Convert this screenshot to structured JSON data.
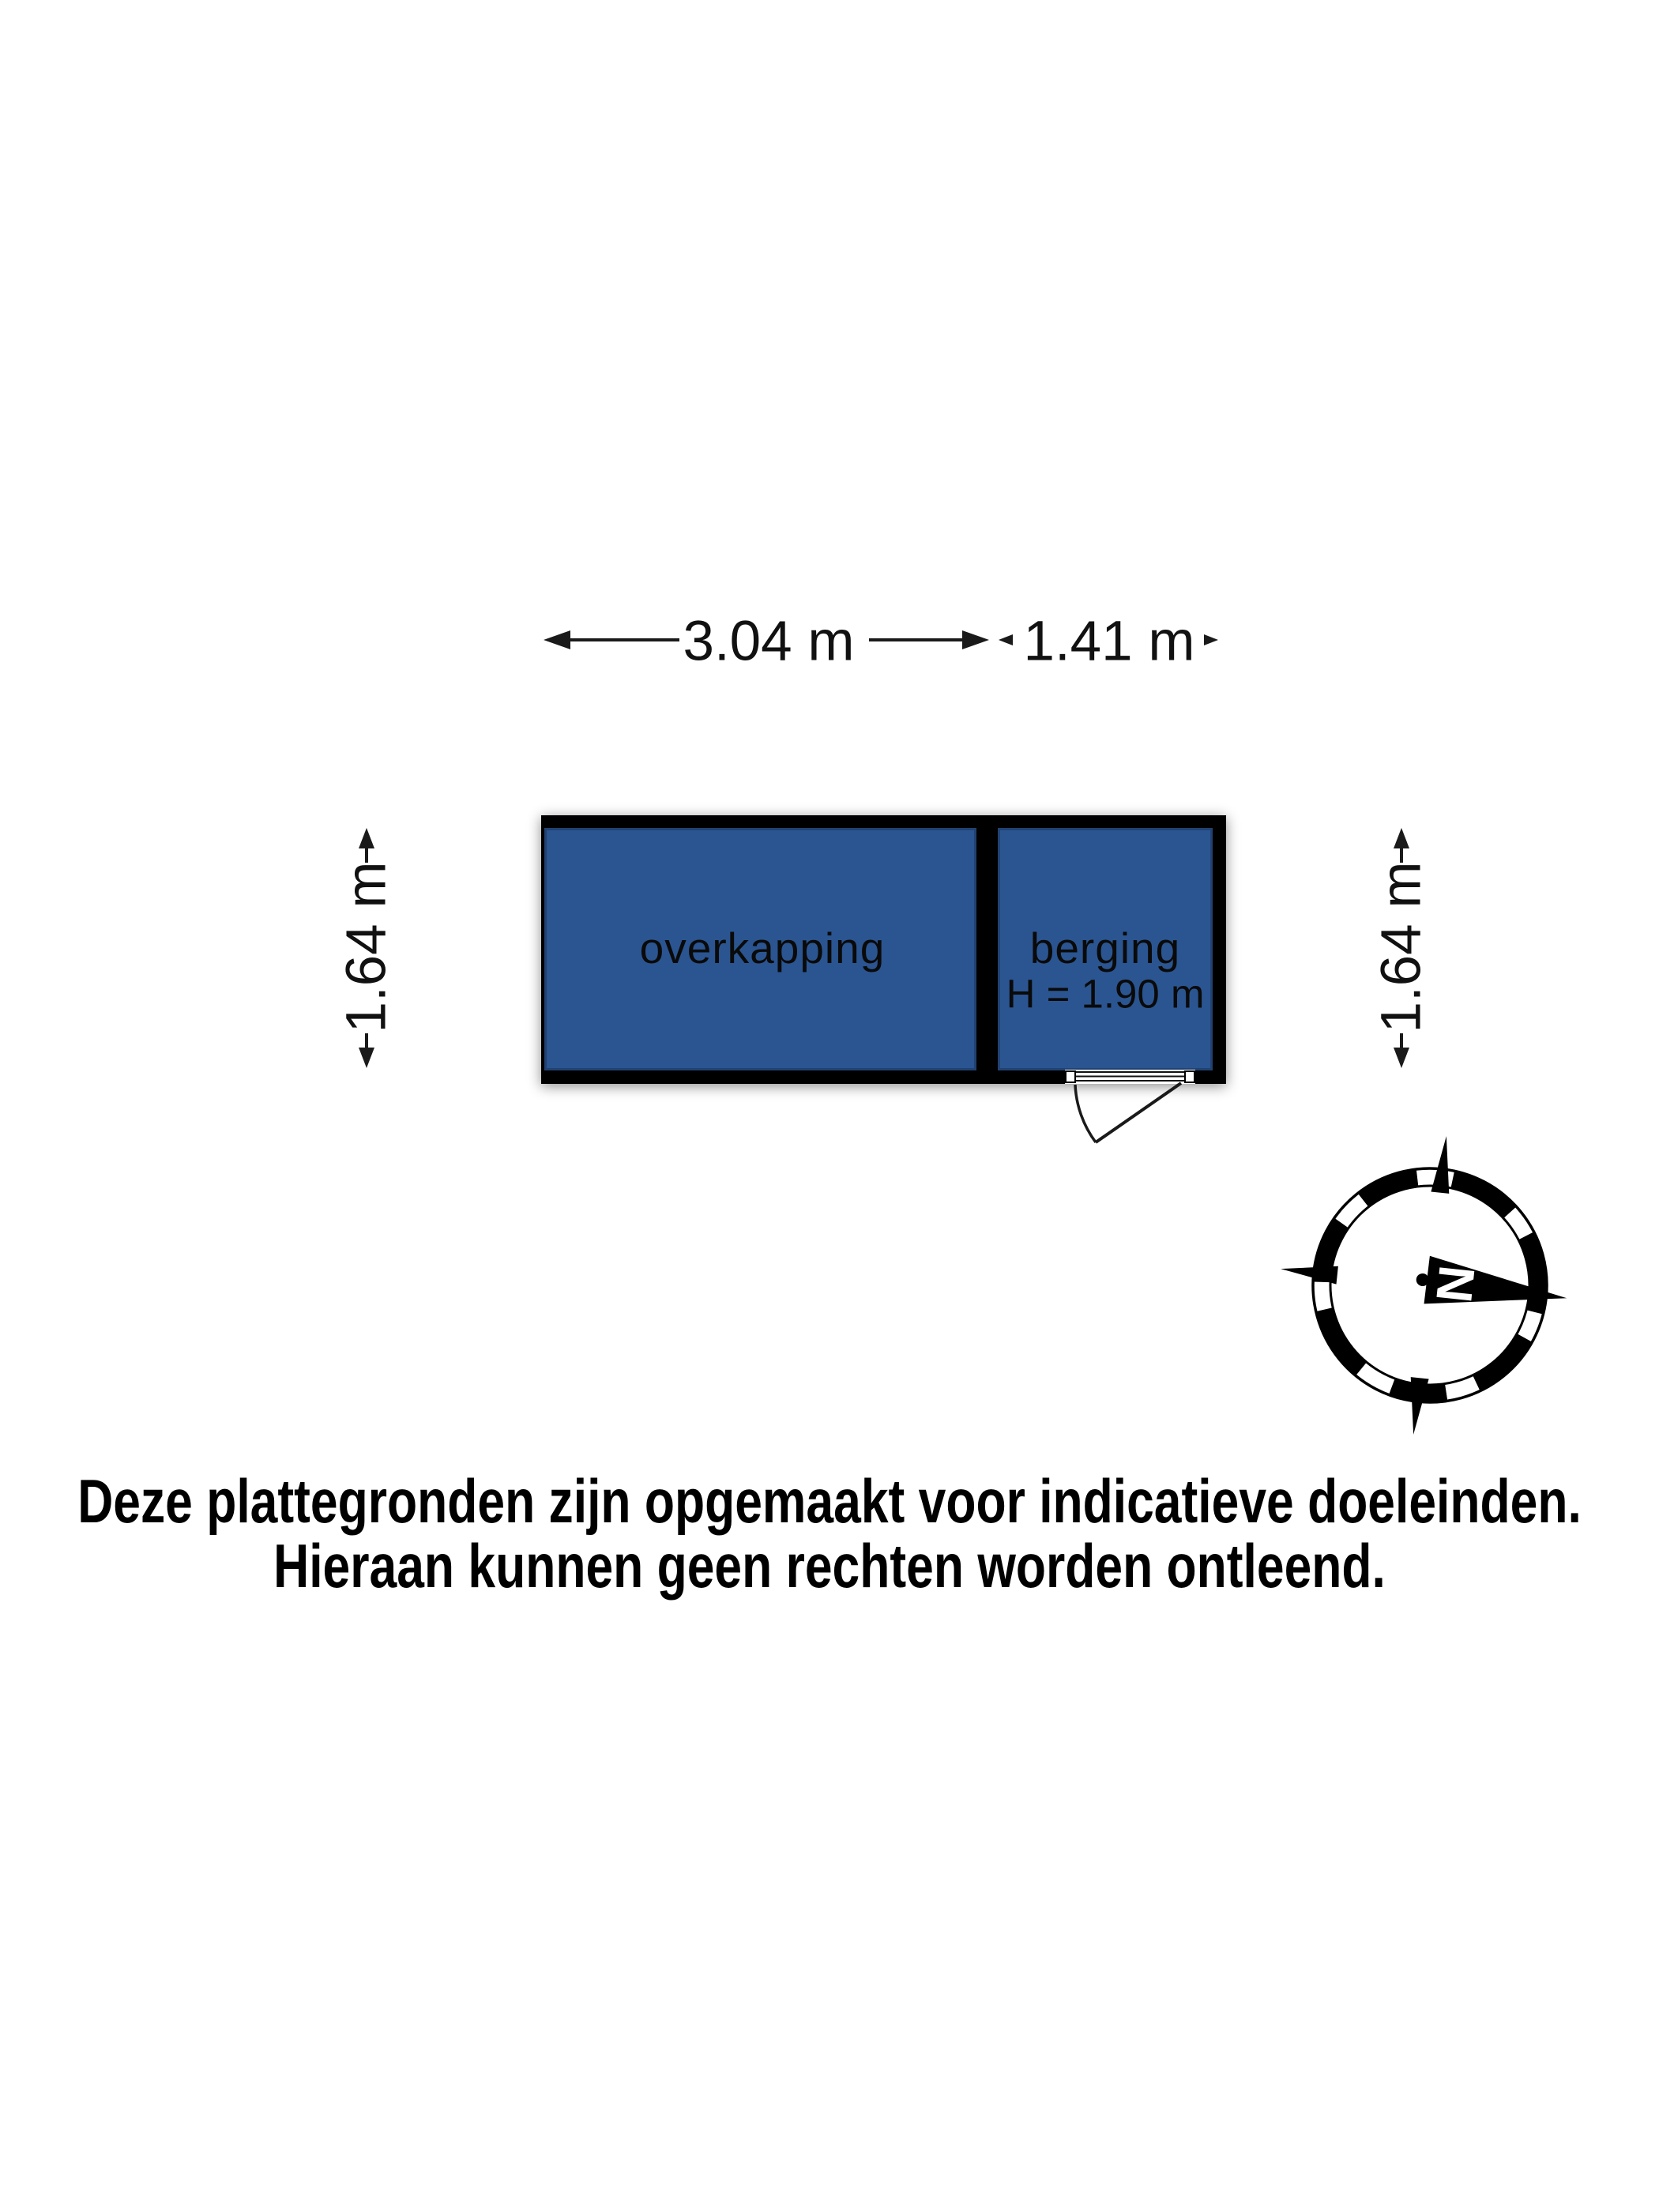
{
  "floorplan": {
    "rooms": [
      {
        "label": "overkapping"
      },
      {
        "label": "berging",
        "height_label": "H = 1.90 m"
      }
    ],
    "dimensions": {
      "width_overkapping": "3.04 m",
      "width_berging": "1.41 m",
      "depth_left": "1.64 m",
      "depth_right": "1.64 m"
    },
    "colors": {
      "room_fill": "#2b5591",
      "wall": "#000000"
    }
  },
  "compass": {
    "north_label": "N"
  },
  "disclaimer": {
    "line1": "Deze plattegronden zijn opgemaakt voor indicatieve doeleinden.",
    "line2": "Hieraan kunnen geen rechten worden ontleend."
  }
}
